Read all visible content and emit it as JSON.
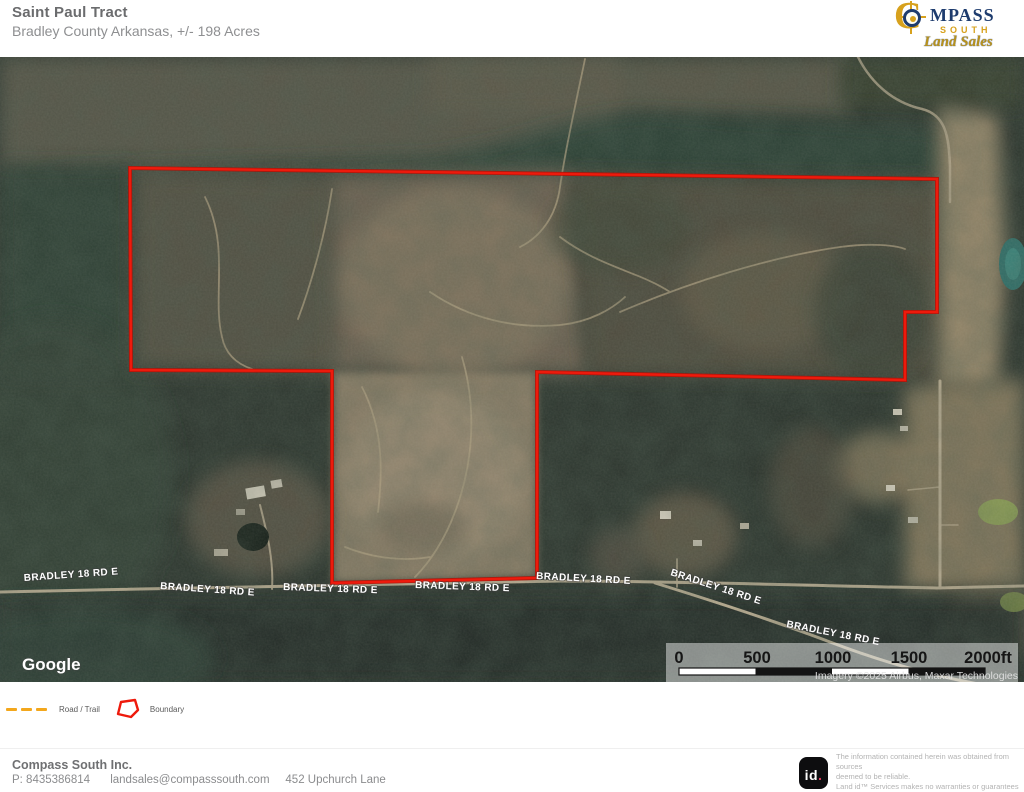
{
  "header": {
    "title": "Saint Paul Tract",
    "subtitle": "Bradley County Arkansas,  +/- 198 Acres",
    "logo": {
      "c": "C",
      "mpass": "MPASS",
      "south": "SOUTH",
      "script": "Land Sales"
    }
  },
  "map": {
    "road_labels": [
      "BRADLEY 18 RD E",
      "BRADLEY 18 RD E",
      "BRADLEY 18 RD E",
      "BRADLEY 18 RD E",
      "BRADLEY 18 RD E",
      "BRADLEY 18 RD E",
      "BRADLEY 18 RD E"
    ],
    "google_logo": "Google",
    "attribution": "Imagery ©2025 Airbus, Maxar Technologies",
    "scale_bar": {
      "ticks": [
        "0",
        "500",
        "1000",
        "1500"
      ],
      "end_label": "2000ft"
    },
    "boundary_color": "#ee1a0c",
    "road_trail_color": "#f3a71c"
  },
  "legend": {
    "road_trail_label": "Road / Trail",
    "boundary_label": "Boundary"
  },
  "footer": {
    "company": "Compass South Inc.",
    "phone": "P: 8435386814",
    "email": "landsales@compasssouth.com",
    "address": "452 Upchurch Lane",
    "brand_mark_text": "id",
    "brand_mark_dot": ".",
    "disclaimer_lines": [
      "The information contained herein was obtained from sources",
      "deemed to be reliable.",
      " Land id™ Services makes no warranties or guarantees as to the",
      "completeness or accuracy thereof."
    ]
  }
}
